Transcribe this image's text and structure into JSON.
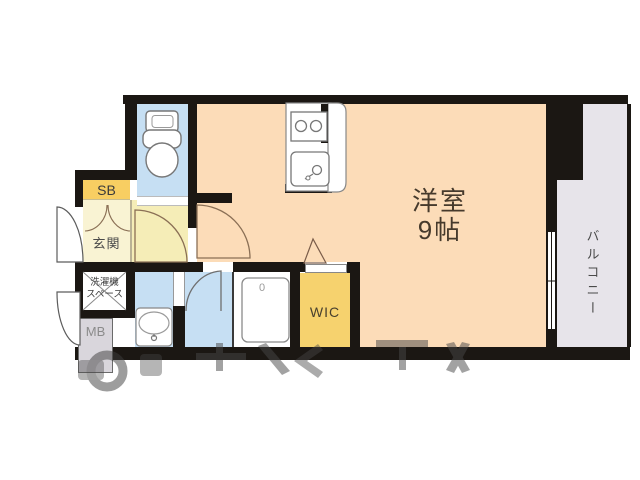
{
  "floorplan": {
    "title": "1R apartment floor plan",
    "wall_color": "#1b1713",
    "rooms": {
      "main_room": {
        "label": "洋室\n9帖",
        "color": "#fcdcb8"
      },
      "balcony": {
        "label": "バルコニー",
        "color": "#e7e4ea"
      },
      "wic": {
        "label": "WIC",
        "color": "#f6d26e"
      },
      "sb": {
        "label": "SB",
        "color": "#f8ce62"
      },
      "genkan": {
        "label": "玄関",
        "color": "#f9f3d3"
      },
      "hall": {
        "color": "#f5edb7"
      },
      "laundry": {
        "label": "洗濯機\nスペース",
        "color": "#ffffff"
      },
      "mb": {
        "label": "MB",
        "color": "#d9d6dc"
      },
      "toilet": {
        "color": "#c6dff3"
      },
      "bath": {
        "color": "#c6dff3"
      },
      "washroom": {
        "color": "#c6dff3"
      },
      "unit_bath": {
        "label": "0",
        "color": "#ffffff"
      }
    }
  }
}
